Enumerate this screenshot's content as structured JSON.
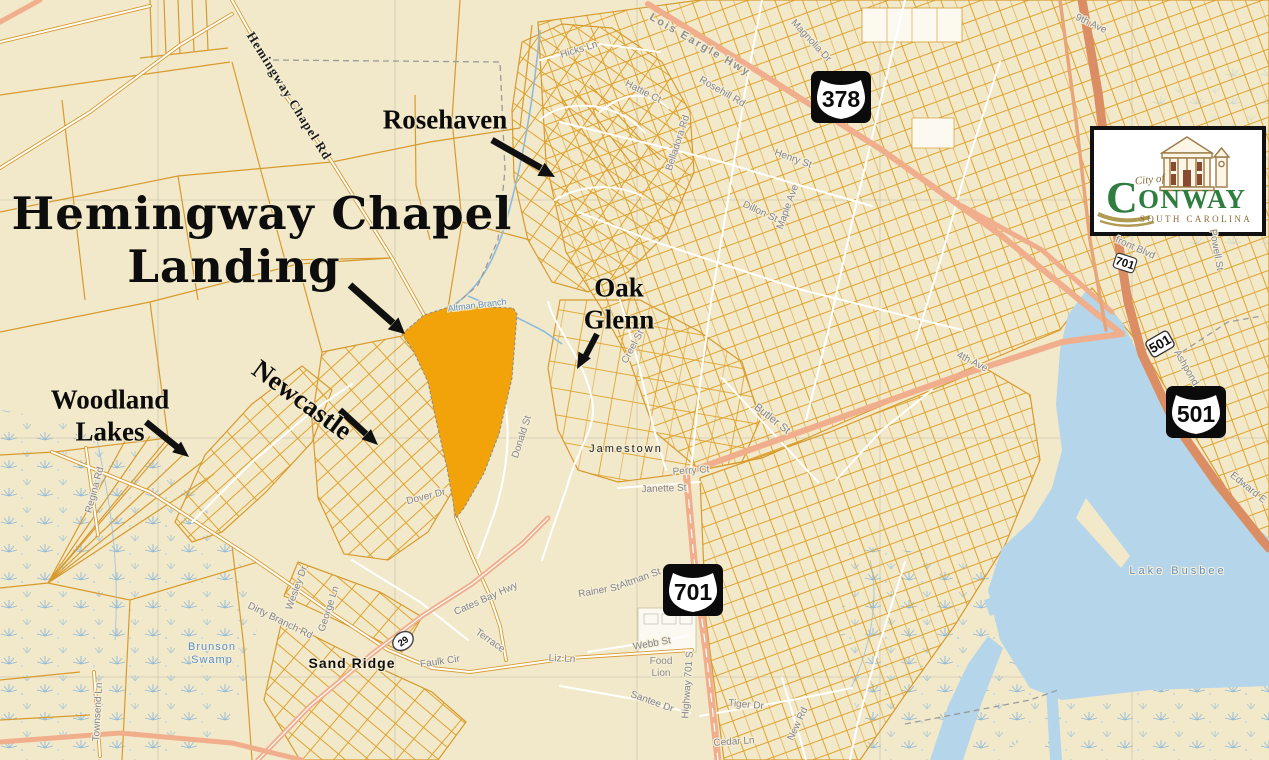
{
  "title": {
    "line1": "Hemingway Chapel",
    "line2": "Landing"
  },
  "callouts": {
    "rosehaven": "Rosehaven",
    "oak_glenn": "Oak\nGlenn",
    "newcastle": "Newcastle",
    "woodland_lakes": "Woodland\nLakes"
  },
  "places": {
    "jamestown": "Jamestown",
    "sand_ridge": "Sand Ridge",
    "food_lion": "Food\nLion"
  },
  "water_labels": {
    "lake_busbee": "Lake Busbee",
    "brunson_swamp": "Brunson\nSwamp",
    "altman_branch": "Altman Branch"
  },
  "roads": {
    "hemingway_chapel_rd": "Hemingway Chapel Rd",
    "lois_eargle_hwy": "Lois Eargle Hwy",
    "highway_701_s": "Highway 701 S",
    "cates_bay_hwy": "Cates Bay Hwy",
    "dirty_branch_rd": "Dirty Branch Rd",
    "ashpond": "Ashpond",
    "edward_e": "Edward E",
    "webb_st": "Webb St",
    "santee_dr": "Santee Dr",
    "tiger_dr": "Tiger Dr",
    "rainer_st": "Rainer St",
    "altman_st": "Altman St",
    "liz_ln": "Liz Ln",
    "faulk_cir": "Faulk Cir",
    "terrace": "Terrace",
    "george_ln": "George Ln",
    "regina_rd": "Regina Rd",
    "townsend_ln": "Townsend Ln",
    "wesley_dr": "Wesley Dr",
    "magnolia_dr": "Magnolia Dr",
    "rosehill_rd": "Rosehill Rd",
    "belladora_rd": "Belladora Rd",
    "henry_st": "Henry St",
    "maple_ave": "Maple Ave",
    "dillon_st": "Dillon St",
    "butler_st": "Butler St",
    "fourth_ave": "4th Ave",
    "donald_st": "Donald St",
    "dover_dr": "Dover Dr",
    "creel_st": "Creel St",
    "janette_st": "Janette St",
    "perry_ct": "Perry Ct",
    "hicks_ln": "Hicks Ln",
    "hattie_ct": "Hattie Ct",
    "new_rd": "New Rd",
    "cedar_ln": "Cedar Ln",
    "ninth_ave": "9th Ave",
    "front_blvd": "front Blvd",
    "powell_st": "Powell St"
  },
  "shields": {
    "us378": "378",
    "us501": "501",
    "us701": "701",
    "us501_small": "501",
    "us701_small": "701",
    "sc29": "29"
  },
  "logo": {
    "city_of": "City of",
    "name_initial": "C",
    "name_rest": "ONWAY",
    "state": "SOUTH CAROLINA"
  },
  "colors": {
    "background": "#F2E9CA",
    "parcel_line": "#DFA32E",
    "highlight_parcel": "#F2A30A",
    "major_road": "#F0AE8C",
    "us501_corridor": "#DB8E63",
    "water": "#B5D5EA",
    "swamp_symbol": "#7FB2DC",
    "logo_green": "#2F7D3F",
    "logo_brown": "#9C7A46"
  }
}
